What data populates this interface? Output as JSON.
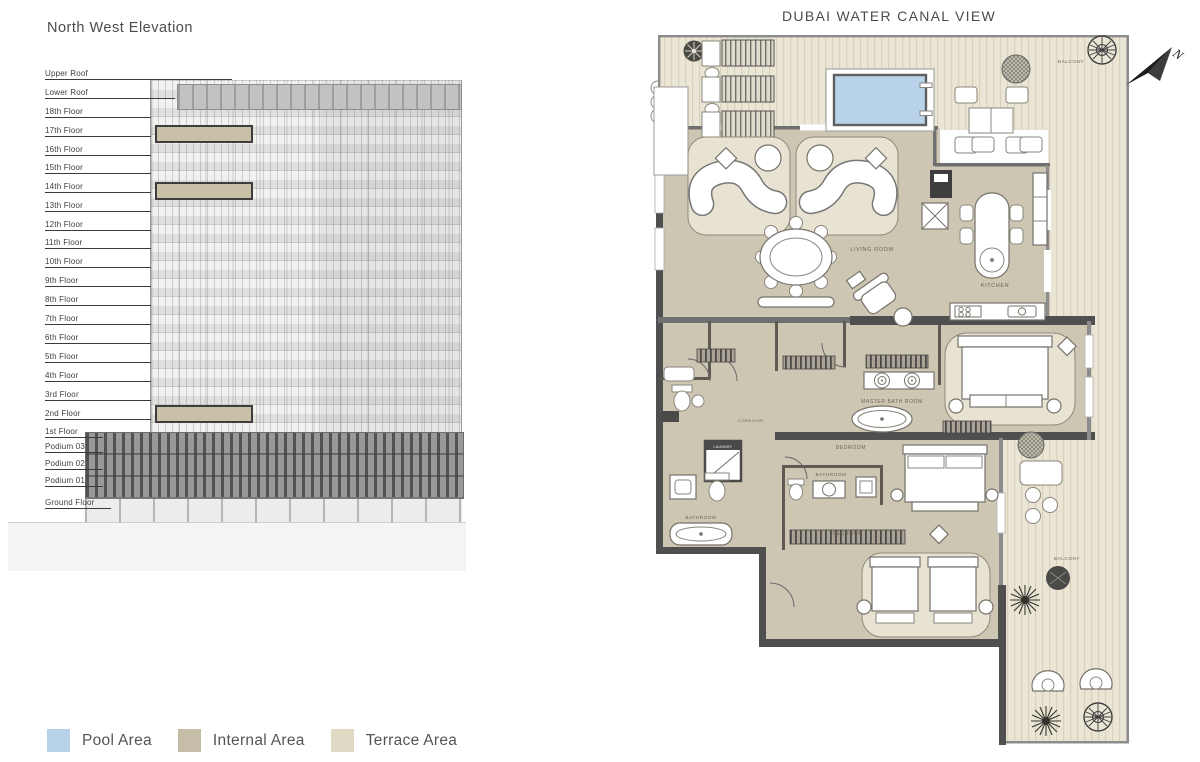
{
  "elevation": {
    "title": "North West Elevation",
    "floors": [
      "Upper Roof",
      "Lower Roof",
      "18th Floor",
      "17th Floor",
      "16th Floor",
      "15th Floor",
      "14th Floor",
      "13th Floor",
      "12th Floor",
      "11th Floor",
      "10th Floor",
      "9th Floor",
      "8th Floor",
      "7th Floor",
      "6th Floor",
      "5th Floor",
      "4th Floor",
      "3rd Floor",
      "2nd Floor",
      "1st Floor",
      "Podium 03",
      "Podium 02",
      "Podium 01",
      "Ground Floor"
    ]
  },
  "floor_plan": {
    "title": "DUBAI WATER CANAL VIEW",
    "compass_label": "N",
    "labels": {
      "balcony_top": "BALCONY",
      "balcony_right": "BALCONY",
      "living_room": "LIVING ROOM",
      "kitchen": "KITCHEN",
      "master_bathroom": "MASTER BATH ROOM",
      "bedroom_middle": "BEDROOM",
      "bedroom_bottom": "BEDROOM",
      "bathroom_middle": "BATHROOM",
      "bathroom_left": "BATHROOM",
      "corridor": "CORRIDOR",
      "laundry": "LAUNDRY"
    },
    "colors": {
      "pool": "#b8d3e9",
      "internal": "#cdc6b3",
      "terrace": "#eae5d4"
    }
  },
  "legend": {
    "items": [
      {
        "label": "Pool Area",
        "color": "#b8d3e9"
      },
      {
        "label": "Internal Area",
        "color": "#c6bda9"
      },
      {
        "label": "Terrace Area",
        "color": "#e0dac5"
      }
    ]
  }
}
